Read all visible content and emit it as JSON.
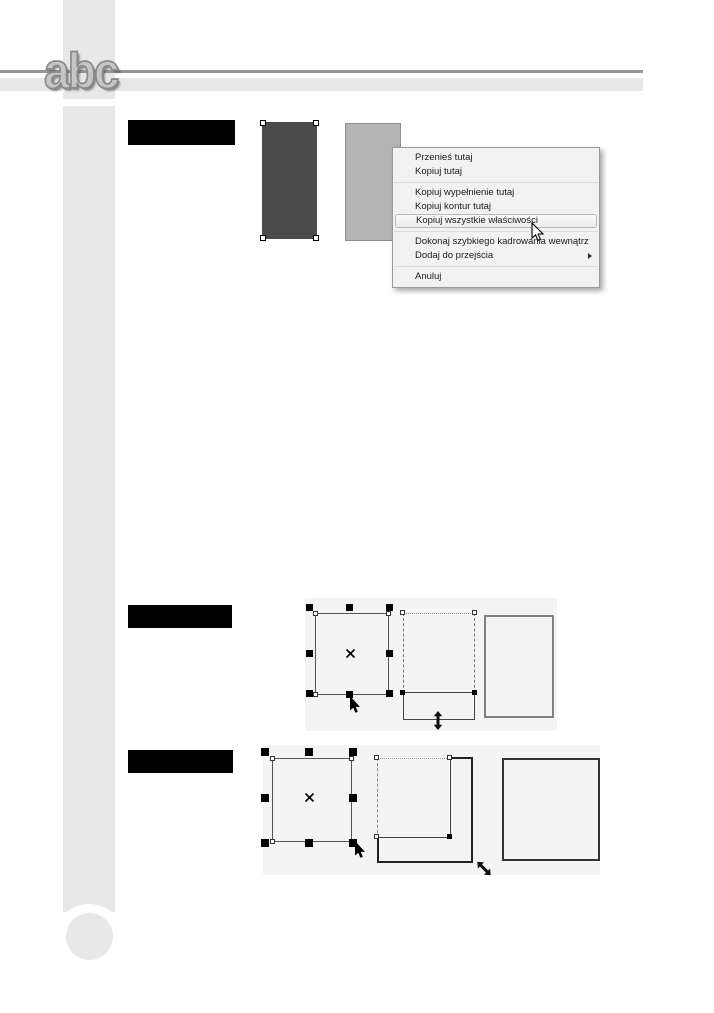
{
  "logo": {
    "text": "abc"
  },
  "context_menu": {
    "items": [
      {
        "label": "Przenieś tutaj"
      },
      {
        "label": "Kopiuj tutaj"
      },
      {
        "label": "Kopiuj wypełnienie tutaj"
      },
      {
        "label": "Kopiuj kontur tutaj"
      },
      {
        "label": "Kopiuj wszystkie właściwości",
        "state": "hover"
      },
      {
        "label": "Dokonaj szybkiego kadrowania wewnątrz"
      },
      {
        "label": "Dodaj do przejścia",
        "has_submenu": true
      },
      {
        "label": "Anuluj"
      }
    ]
  },
  "colors": {
    "page_bg": "#ffffff",
    "strip": "#e8e8e8",
    "rule_dark": "#969696",
    "rule_light": "#e8e8e8",
    "redacted_bar": "#000000",
    "rect_dark_fill": "#4b4b4b",
    "rect_light_fill": "#b5b5b5",
    "menu_bg": "#f2f2f2",
    "menu_border": "#9a9a9a",
    "menu_text": "#1a1a1a",
    "menu_highlight_border": "#b9b9b9",
    "figure_bg": "#f4f4f4",
    "handle": "#000000",
    "outline": "#555555"
  }
}
